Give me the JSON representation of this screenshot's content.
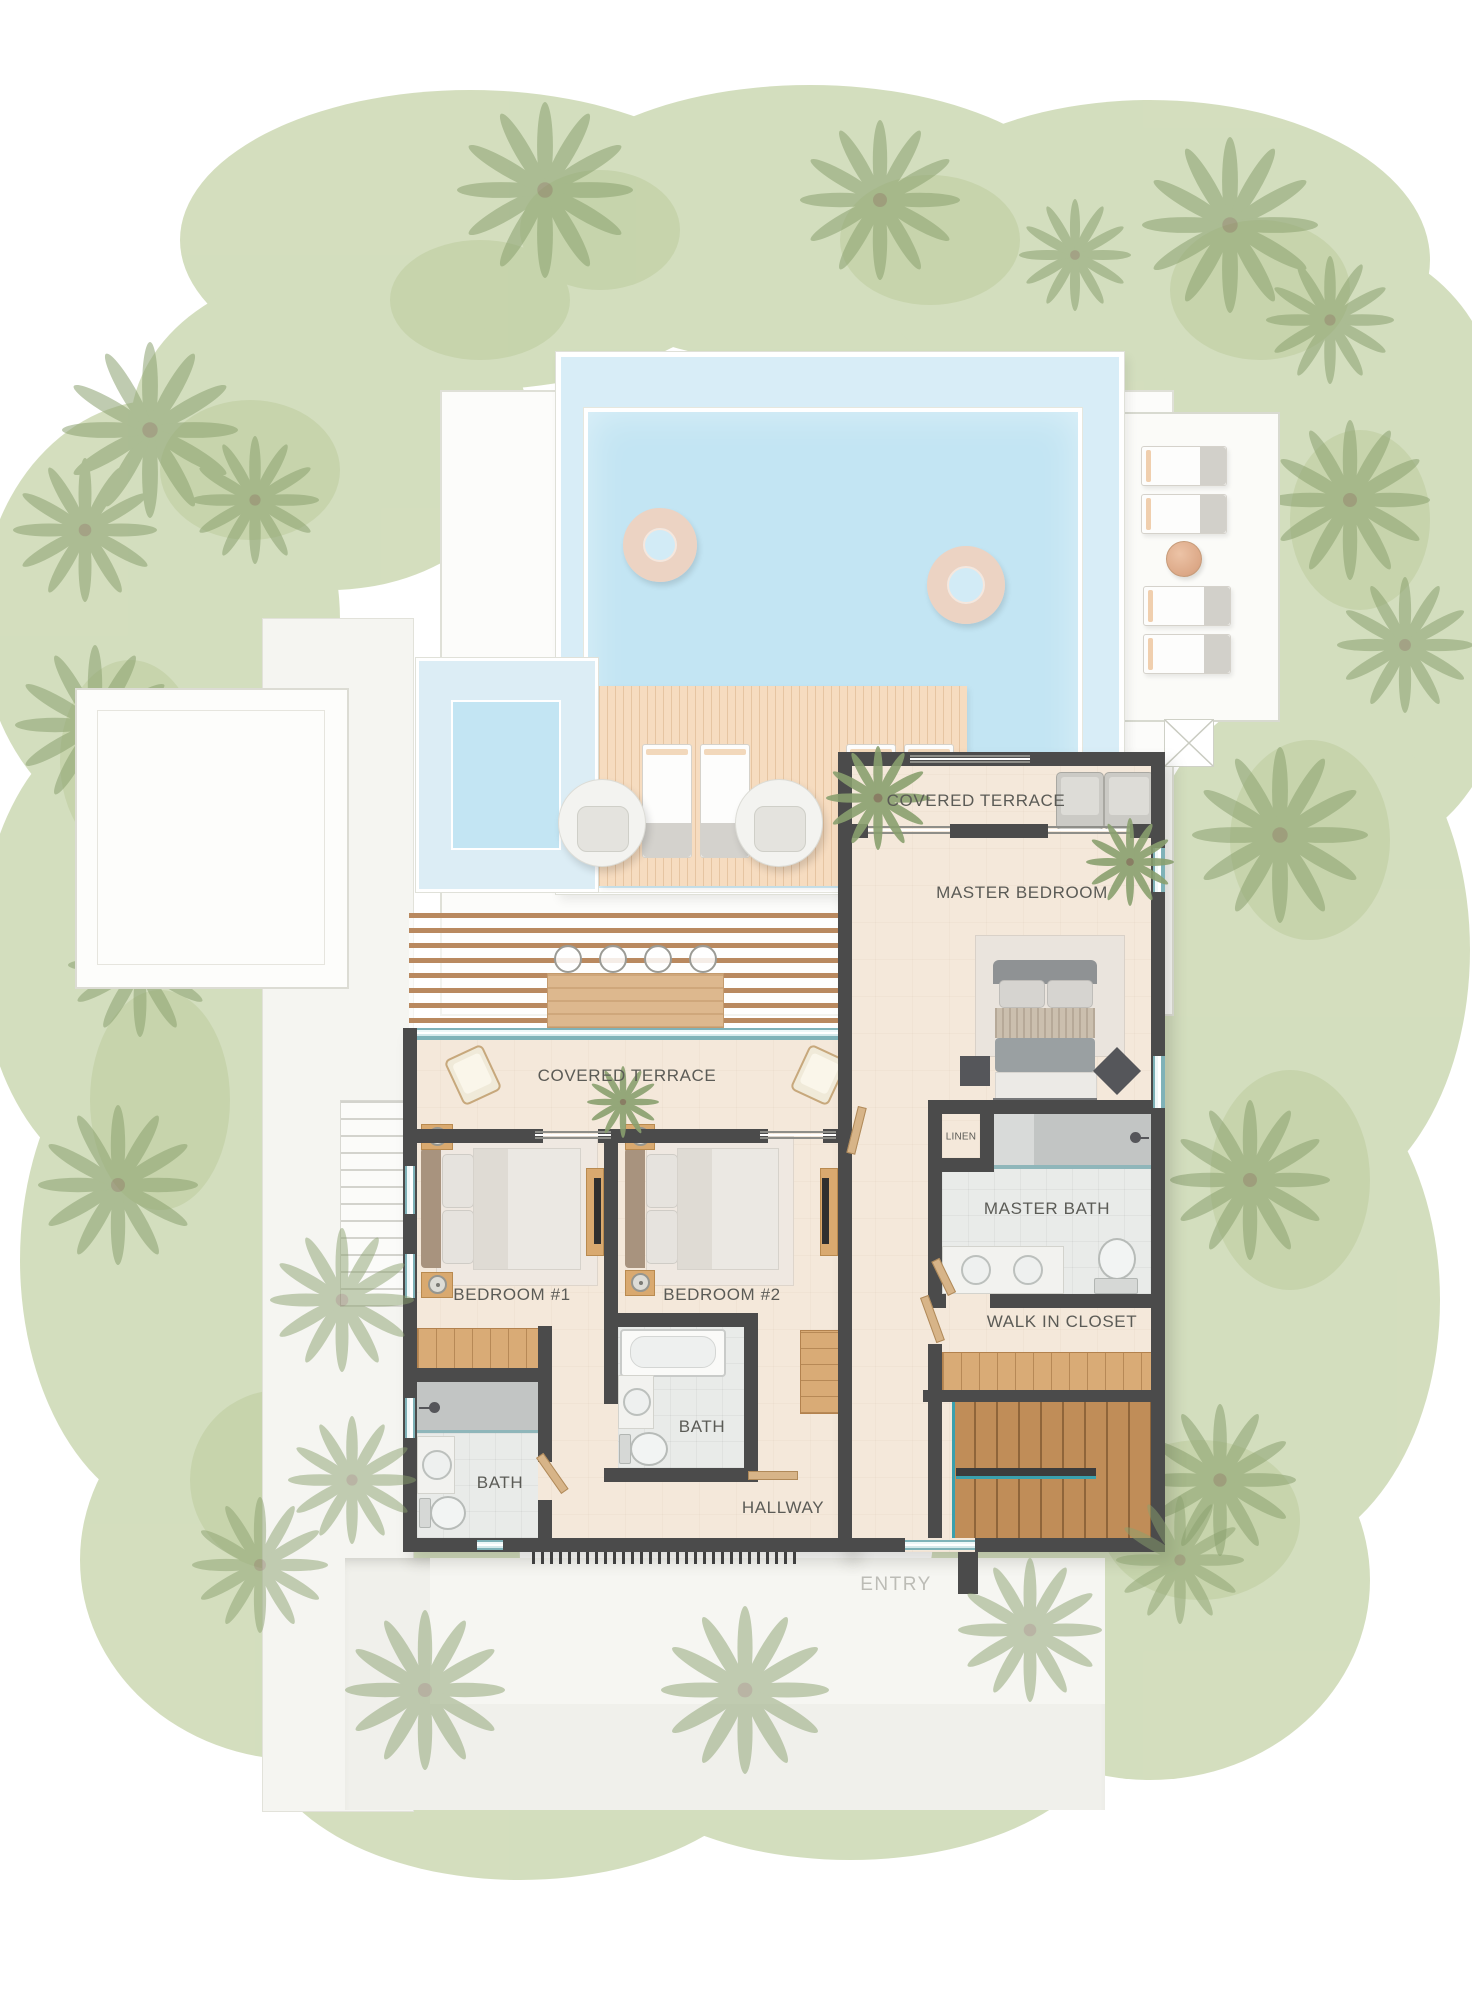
{
  "plan": {
    "rooms": {
      "master_terrace": {
        "label": "COVERED TERRACE"
      },
      "master_bedroom": {
        "label": "MASTER BEDROOM"
      },
      "terrace": {
        "label": "COVERED TERRACE"
      },
      "linen": {
        "label": "LINEN"
      },
      "master_bath": {
        "label": "MASTER BATH"
      },
      "bedroom1": {
        "label": "BEDROOM #1"
      },
      "bedroom2": {
        "label": "BEDROOM #2"
      },
      "walk_in_closet": {
        "label": "WALK IN CLOSET"
      },
      "bath1": {
        "label": "BATH"
      },
      "bath2": {
        "label": "BATH"
      },
      "hallway": {
        "label": "HALLWAY"
      },
      "entry": {
        "label": "ENTRY"
      }
    },
    "colors": {
      "wall": "#4b4b4b",
      "floor": "#f4e8da",
      "pool_water": "#c3e5f3",
      "pool_shallow": "#d8edf7",
      "deck_wood": "#f6dcc0",
      "stair_wood": "#c08d58",
      "closet_wood": "#d9ab76",
      "grass": "#c9d6ae",
      "palm": "#8aa06f",
      "tile": "#e9ebe9",
      "shower_tile": "#c2c5c4",
      "glass": "#7fb2b8",
      "label_text": "#5b5b56",
      "entry_text": "#bcbcb6"
    }
  }
}
